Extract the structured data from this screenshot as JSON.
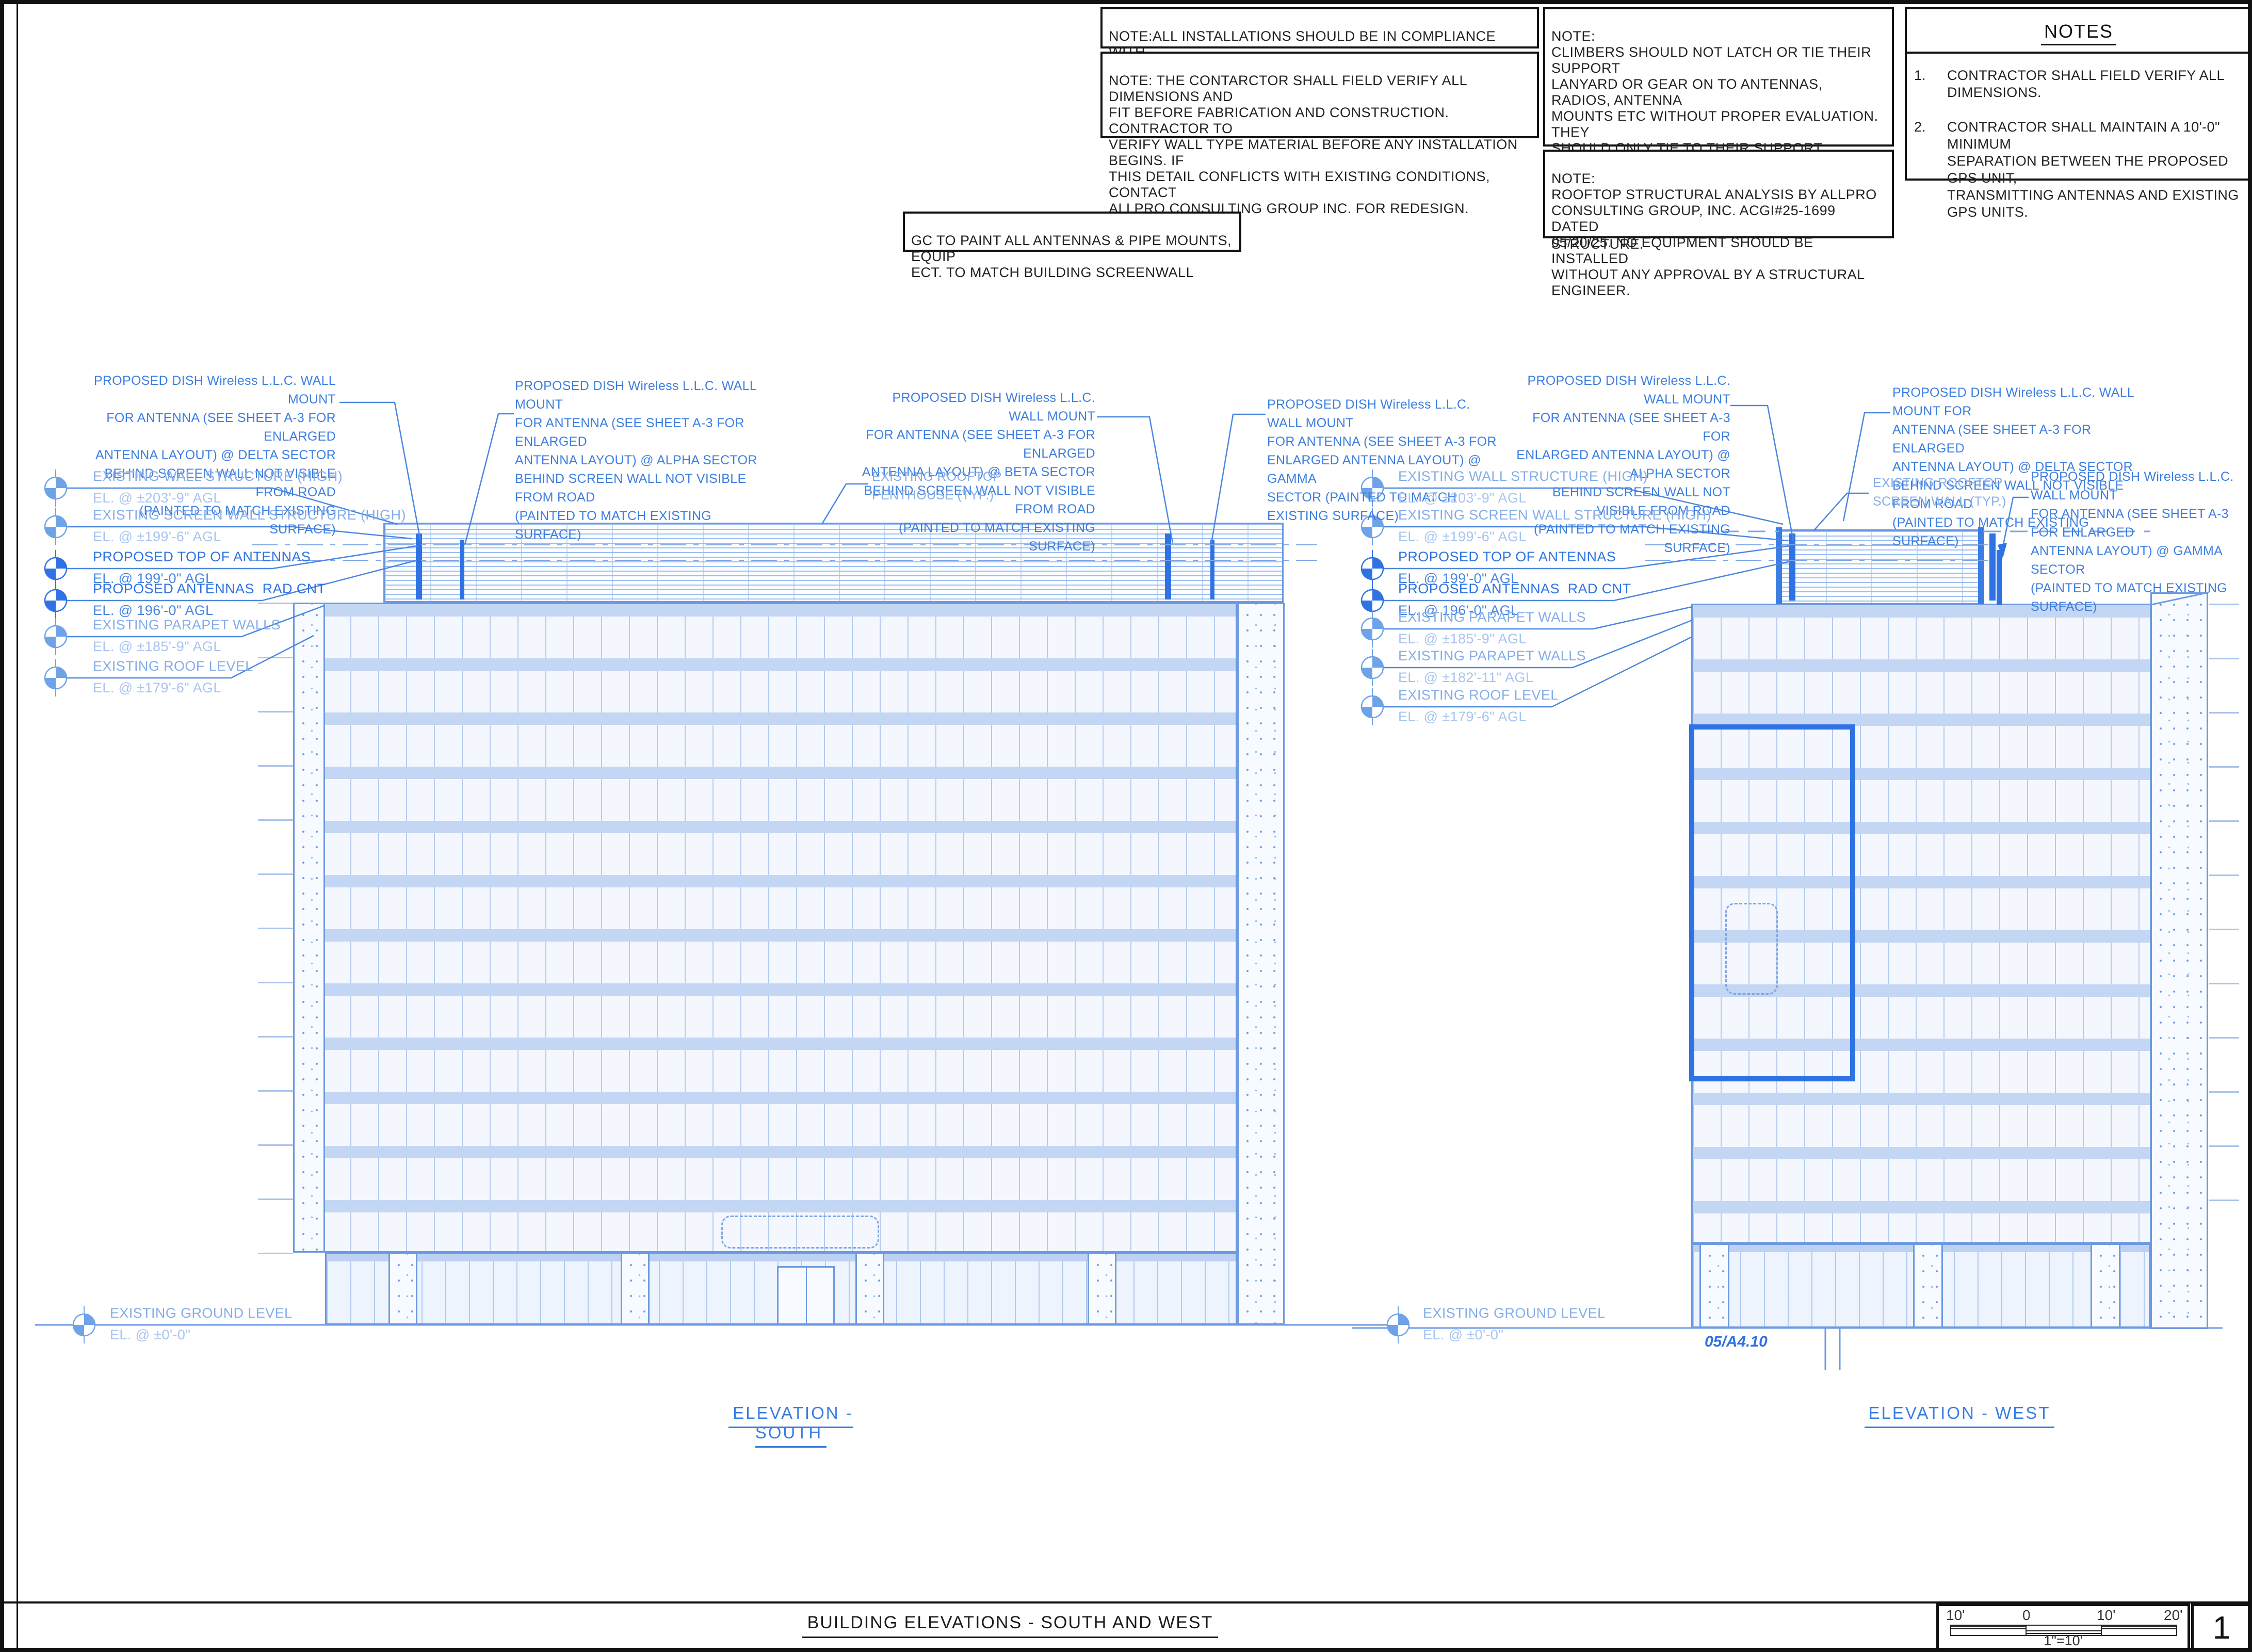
{
  "colors": {
    "annotation_blue": "#3d7ee0",
    "proposed_blue": "#2e72e4",
    "existing_blue": "#85ade9",
    "line_blue": "#6d9ae0"
  },
  "top_notes": {
    "compliance": "NOTE:ALL INSTALLATIONS SHOULD BE IN COMPLIANCE WITH\nANSI/ASSE A10.48 AND ANY OTHER SAFETY STANDARDS.",
    "field_verify": "NOTE: THE CONTARCTOR SHALL FIELD VERIFY ALL DIMENSIONS AND\nFIT BEFORE FABRICATION AND CONSTRUCTION. CONTRACTOR TO\nVERIFY WALL TYPE MATERIAL BEFORE ANY INSTALLATION BEGINS. IF\nTHIS DETAIL CONFLICTS WITH EXISTING CONDITIONS, CONTACT\nALLPRO CONSULTING GROUP INC. FOR REDESIGN.",
    "climbers": "NOTE:\nCLIMBERS SHOULD NOT LATCH OR TIE THEIR SUPPORT\nLANYARD OR GEAR ON TO ANTENNAS, RADIOS, ANTENNA\nMOUNTS ETC WITHOUT PROPER EVALUATION. THEY\nSHOULD ONLY TIE TO THEIR SUPPORT LANYARDS OR\nGEAR TO OR ATTACH TO STRUCTURAL MEMBERS THAT\nHAVE VISIBLE BOLTING AND CONNECTION TO THE LARGER\nSTRUCTURE.",
    "structural": "NOTE:\nROOFTOP STRUCTURAL ANALYSIS BY ALLPRO\nCONSULTING GROUP, INC. ACGI#25-1699 DATED\n05/20/25. NO EQUIPMENT SHOULD BE INSTALLED\nWITHOUT ANY APPROVAL BY A STRUCTURAL ENGINEER.",
    "paint": "GC TO PAINT ALL ANTENNAS & PIPE MOUNTS, EQUIP\nECT. TO MATCH BUILDING SCREENWALL"
  },
  "notes_panel": {
    "title": "NOTES",
    "item1_num": "1.",
    "item1": "CONTRACTOR SHALL FIELD VERIFY ALL DIMENSIONS.",
    "item2_num": "2.",
    "item2": "CONTRACTOR SHALL MAINTAIN A 10'-0\" MINIMUM\nSEPARATION BETWEEN THE PROPOSED GPS UNIT,\nTRANSMITTING ANTENNAS AND EXISTING GPS UNITS."
  },
  "south": {
    "title": "ELEVATION  -  SOUTH",
    "callout_delta": "PROPOSED DISH Wireless L.L.C. WALL MOUNT\nFOR ANTENNA  (SEE SHEET A-3 FOR ENLARGED\nANTENNA LAYOUT) @ DELTA SECTOR\nBEHIND SCREEN WALL NOT VISIBLE FROM ROAD\n(PAINTED TO MATCH EXISTING SURFACE)",
    "callout_alpha": "PROPOSED DISH Wireless L.L.C. WALL MOUNT\nFOR ANTENNA  (SEE SHEET A-3 FOR ENLARGED\nANTENNA LAYOUT) @ ALPHA SECTOR\nBEHIND SCREEN WALL NOT VISIBLE FROM ROAD\n(PAINTED TO MATCH EXISTING SURFACE)",
    "callout_beta": "PROPOSED DISH Wireless L.L.C. WALL MOUNT\nFOR ANTENNA  (SEE SHEET A-3 FOR ENLARGED\nANTENNA LAYOUT) @ BETA SECTOR\nBEHIND SCREEN WALL NOT VISIBLE FROM ROAD\n(PAINTED TO MATCH EXISTING SURFACE)",
    "callout_gamma": "PROPOSED DISH Wireless L.L.C. WALL MOUNT\nFOR ANTENNA  (SEE SHEET A-3 FOR\nENLARGED ANTENNA LAYOUT) @ GAMMA\nSECTOR (PAINTED TO MATCH EXISTING SURFACE)",
    "rooftop_label": "EXISTING ROOFTOP\nPENTHOUSE (TYP.)",
    "datums": [
      {
        "name": "EXISTING WALL STRUCTURE (HIGH)",
        "el": "EL. @ ±203'-9\" AGL"
      },
      {
        "name": "EXISTING SCREEN WALL STRUCTURE (HIGH)",
        "el": "EL. @ ±199'-6\" AGL"
      },
      {
        "name": "PROPOSED TOP OF ANTENNAS",
        "el": "EL. @ 199'-0\" AGL"
      },
      {
        "name": "PROPOSED ANTENNAS  RAD CNT",
        "el": "EL. @ 196'-0\" AGL"
      },
      {
        "name": "EXISTING PARAPET WALLS",
        "el": "EL. @ ±185'-9\" AGL"
      },
      {
        "name": "EXISTING ROOF LEVEL",
        "el": "EL. @ ±179'-6\" AGL"
      }
    ],
    "ground": {
      "name": "EXISTING GROUND LEVEL",
      "el": "EL. @ ±0'-0\""
    }
  },
  "west": {
    "title": "ELEVATION  -  WEST",
    "callout_alpha": "PROPOSED DISH Wireless L.L.C. WALL MOUNT\nFOR ANTENNA  (SEE SHEET A-3 FOR\nENLARGED ANTENNA LAYOUT) @ ALPHA SECTOR\nBEHIND SCREEN WALL NOT VISIBLE FROM ROAD\n(PAINTED TO MATCH EXISTING SURFACE)",
    "callout_delta": "PROPOSED DISH Wireless L.L.C. WALL MOUNT FOR\nANTENNA  (SEE SHEET A-3 FOR ENLARGED\nANTENNA LAYOUT) @ DELTA SECTOR\nBEHIND SCREEN WALL NOT VISIBLE FROM ROAD\n(PAINTED TO MATCH EXISTING SURFACE)",
    "callout_gamma": "PROPOSED DISH Wireless L.L.C. WALL MOUNT\nFOR ANTENNA  (SEE SHEET A-3 FOR ENLARGED\nANTENNA LAYOUT) @ GAMMA SECTOR\n(PAINTED TO MATCH EXISTING SURFACE)",
    "screenwall_label": "EXISTING ROOFTOP\nSCREEN WALL (TYP.)",
    "ref": "05/A4.10",
    "datums": [
      {
        "name": "EXISTING WALL STRUCTURE (HIGH)",
        "el": "EL. @ ±203'-9\" AGL"
      },
      {
        "name": "EXISTING SCREEN WALL STRUCTURE (HIGH)",
        "el": "EL. @ ±199'-6\" AGL"
      },
      {
        "name": "PROPOSED TOP OF ANTENNAS",
        "el": "EL. @ 199'-0\" AGL"
      },
      {
        "name": "PROPOSED ANTENNAS  RAD CNT",
        "el": "EL. @ 196'-0\" AGL"
      },
      {
        "name": "EXISTING PARAPET WALLS",
        "el": "EL. @ ±185'-9\" AGL"
      },
      {
        "name": "EXISTING PARAPET WALLS",
        "el": "EL. @ ±182'-11\" AGL"
      },
      {
        "name": "EXISTING ROOF LEVEL",
        "el": "EL. @ ±179'-6\" AGL"
      }
    ],
    "ground": {
      "name": "EXISTING GROUND LEVEL",
      "el": "EL. @ ±0'-0\""
    }
  },
  "titleblock": {
    "title": "BUILDING ELEVATIONS  -  SOUTH AND WEST",
    "scale_labels": [
      "10'",
      "0",
      "10'",
      "20'"
    ],
    "scale_ratio": "1\"=10'",
    "page_number": "1"
  }
}
